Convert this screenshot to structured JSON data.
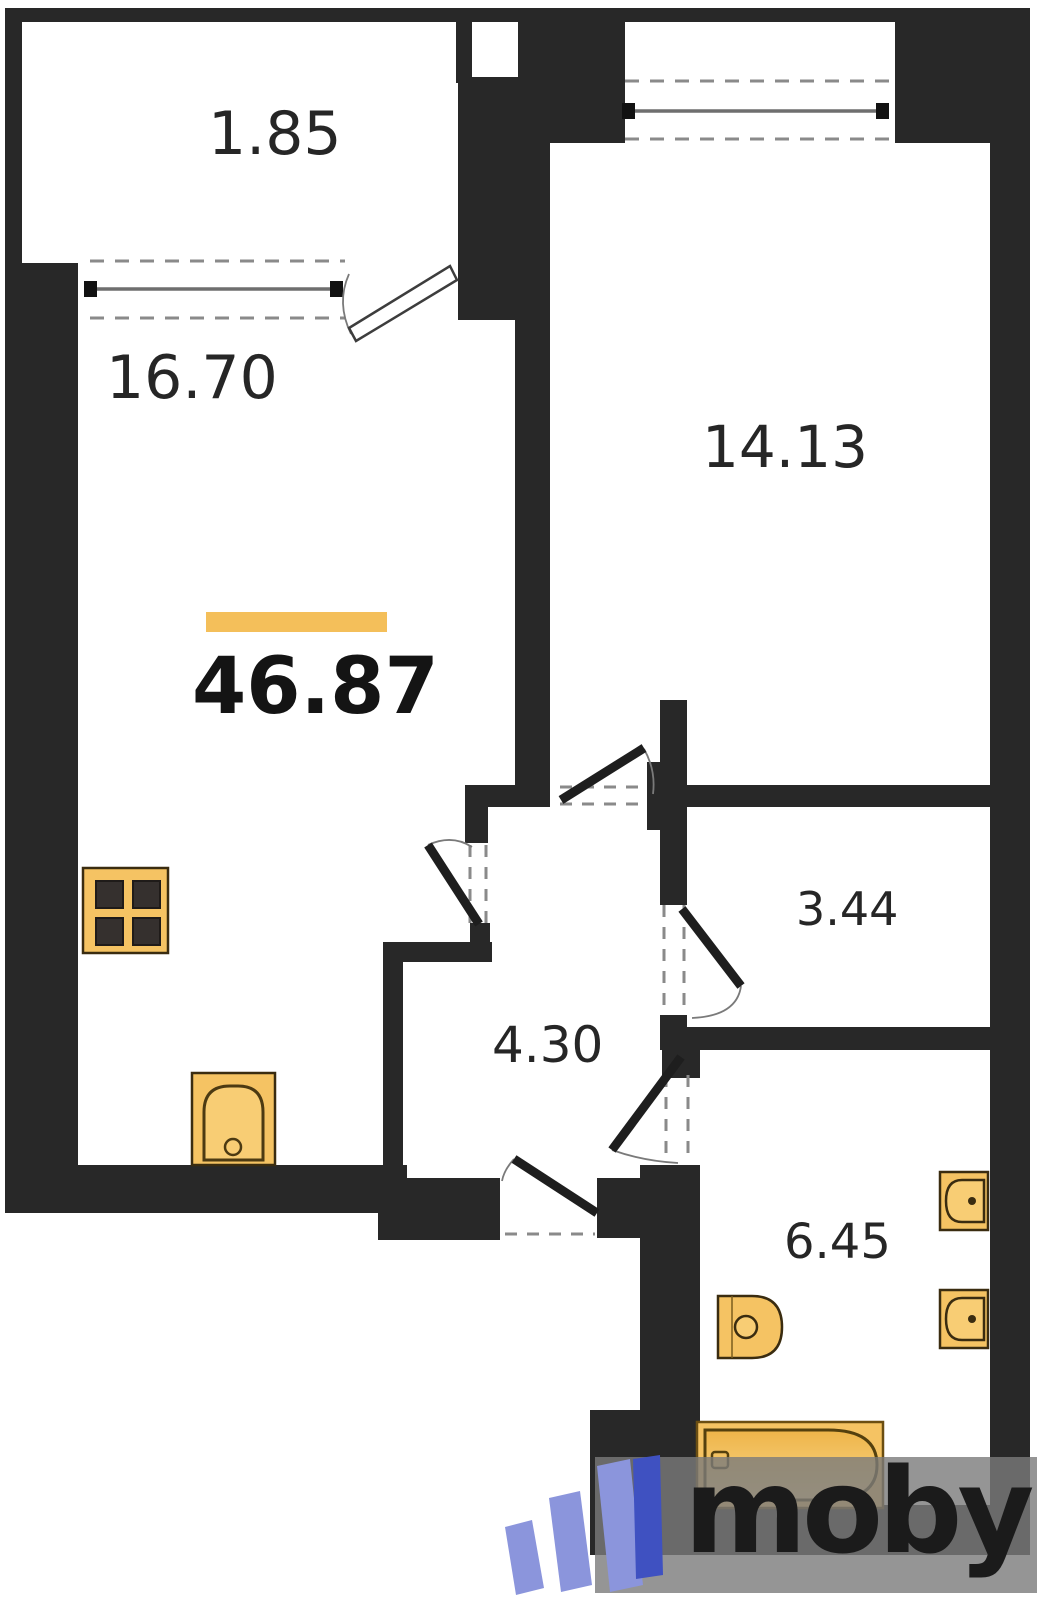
{
  "plan": {
    "title": "apartment-floor-plan",
    "total_area": "46.87",
    "rooms": {
      "balcony": {
        "area": "1.85"
      },
      "living": {
        "area": "16.70"
      },
      "bedroom": {
        "area": "14.13"
      },
      "storage": {
        "area": "3.44"
      },
      "hall": {
        "area": "4.30"
      },
      "bathroom": {
        "area": "6.45"
      }
    },
    "fixtures": [
      "stove",
      "kitchen-sink",
      "toilet",
      "bathtub",
      "bathroom-sink",
      "bathroom-sink-2"
    ],
    "icons": [
      "stove-icon",
      "kitchen-sink-icon",
      "toilet-icon",
      "bathtub-icon",
      "bathroom-sink-icon",
      "window-icon",
      "door-icon",
      "moby-logo-icon"
    ]
  },
  "watermark": {
    "logo_text": "moby"
  },
  "colors": {
    "wall": "#282828",
    "accent": "#f4bf5a",
    "fixture": "#f5c363",
    "fixture-inner": "#f8cd74",
    "fixture-stroke": "#3a2c10",
    "text": "#262626",
    "logo-blue": "#8b95dc",
    "logo-blue-dark": "#3f51c1",
    "wm-text": "#1b1b1b"
  }
}
